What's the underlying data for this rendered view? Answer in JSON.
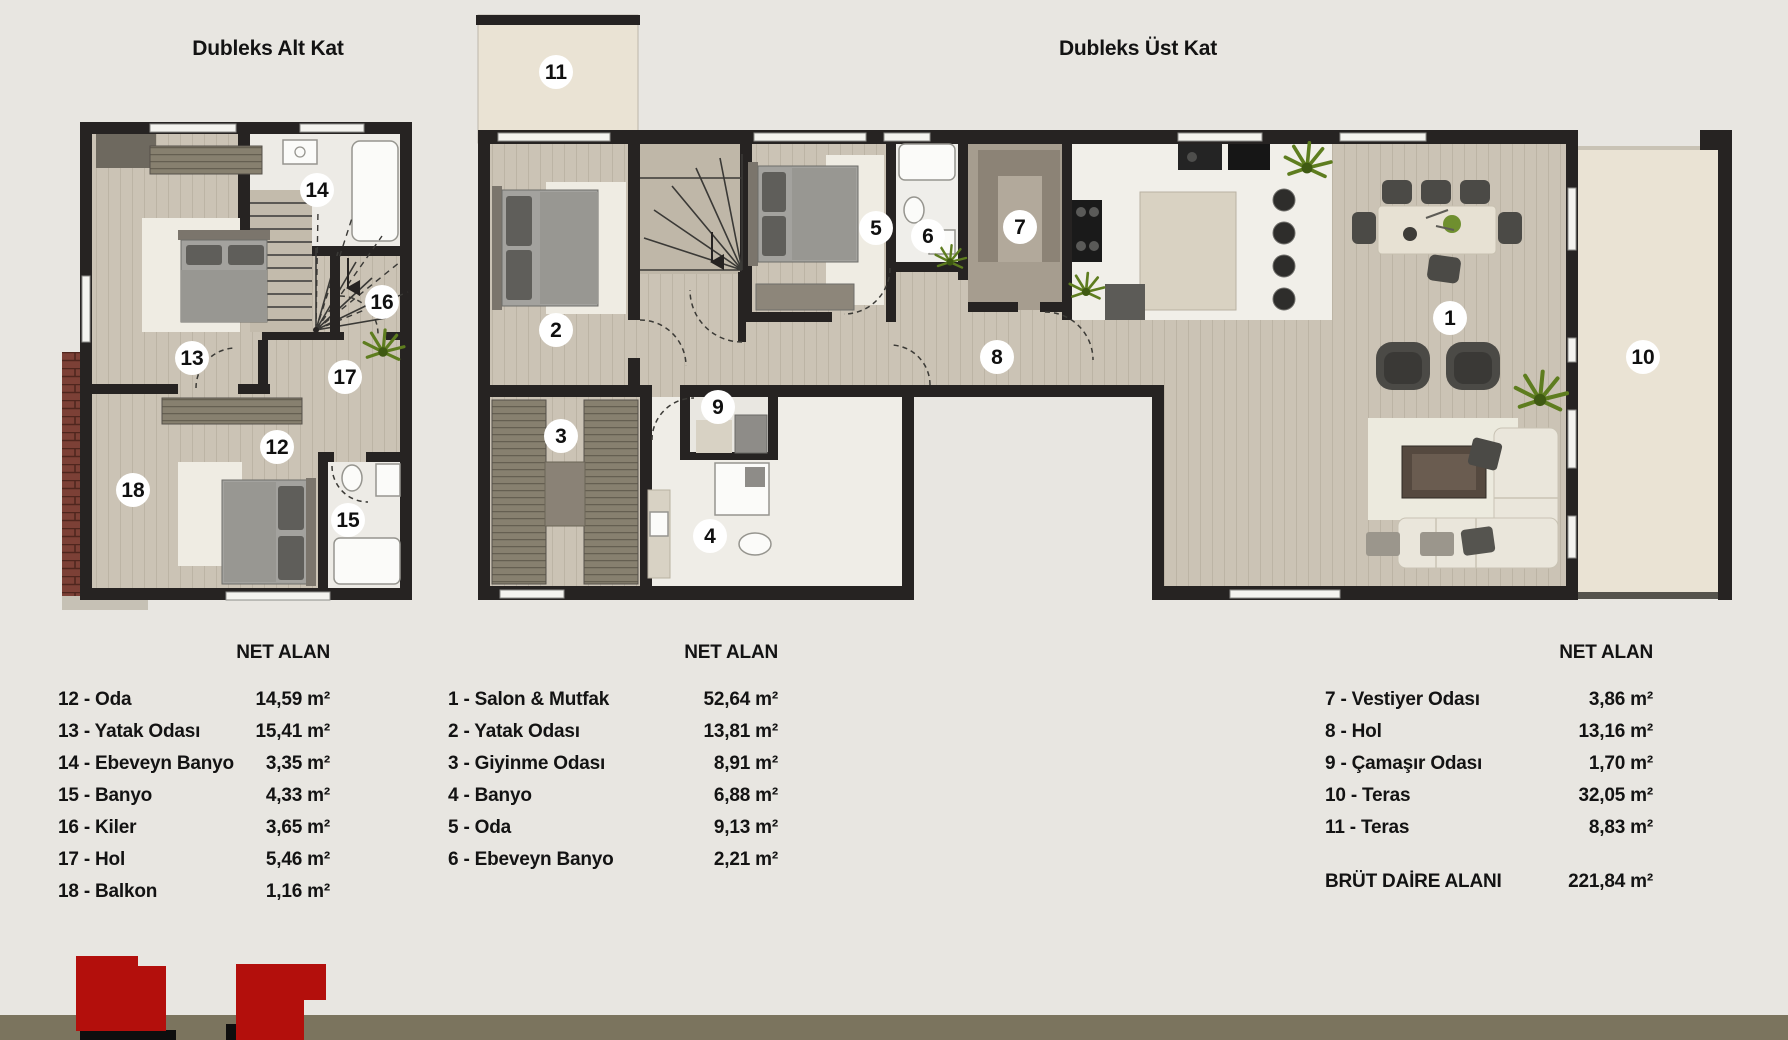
{
  "titles": {
    "left_plan": "Dubleks Alt Kat",
    "right_plan": "Dubleks Üst Kat"
  },
  "legend": {
    "header": "NET ALAN",
    "lower_floor_rows": [
      {
        "label": "12 - Oda",
        "value": "14,59 m²"
      },
      {
        "label": "13 - Yatak Odası",
        "value": "15,41 m²"
      },
      {
        "label": "14 - Ebeveyn Banyo",
        "value": "3,35 m²"
      },
      {
        "label": "15 - Banyo",
        "value": "4,33 m²"
      },
      {
        "label": "16 - Kiler",
        "value": "3,65 m²"
      },
      {
        "label": "17 - Hol",
        "value": "5,46 m²"
      },
      {
        "label": "18 - Balkon",
        "value": "1,16 m²"
      }
    ],
    "upper_floor_rows_1": [
      {
        "label": "1 - Salon & Mutfak",
        "value": "52,64 m²"
      },
      {
        "label": "2 - Yatak Odası",
        "value": "13,81 m²"
      },
      {
        "label": "3 - Giyinme Odası",
        "value": "8,91 m²"
      },
      {
        "label": "4 - Banyo",
        "value": "6,88 m²"
      },
      {
        "label": "5 - Oda",
        "value": "9,13 m²"
      },
      {
        "label": "6 - Ebeveyn Banyo",
        "value": "2,21 m²"
      }
    ],
    "upper_floor_rows_2": [
      {
        "label": "7 - Vestiyer Odası",
        "value": "3,86 m²"
      },
      {
        "label": "8 - Hol",
        "value": "13,16 m²"
      },
      {
        "label": "9 - Çamaşır Odası",
        "value": "1,70 m²"
      },
      {
        "label": "10 - Teras",
        "value": "32,05 m²"
      },
      {
        "label": "11 - Teras",
        "value": "8,83 m²"
      }
    ],
    "gross_area": {
      "label": "BRÜT DAİRE ALANI",
      "value": "221,84 m²"
    }
  },
  "rooms": {
    "r1": "1",
    "r2": "2",
    "r3": "3",
    "r4": "4",
    "r5": "5",
    "r6": "6",
    "r7": "7",
    "r8": "8",
    "r9": "9",
    "r10": "10",
    "r11": "11",
    "r12": "12",
    "r13": "13",
    "r14": "14",
    "r15": "15",
    "r16": "16",
    "r17": "17",
    "r18": "18"
  },
  "colors": {
    "background": "#e8e6e1",
    "wall": "#262322",
    "wood_floor": "#cbc3b5",
    "terrace_floor": "#eae3d4",
    "bath_floor": "#edebe6",
    "balcony_brick": "#7c4036",
    "footer_band": "#7b745e",
    "logo_red": "#b30f0c"
  }
}
